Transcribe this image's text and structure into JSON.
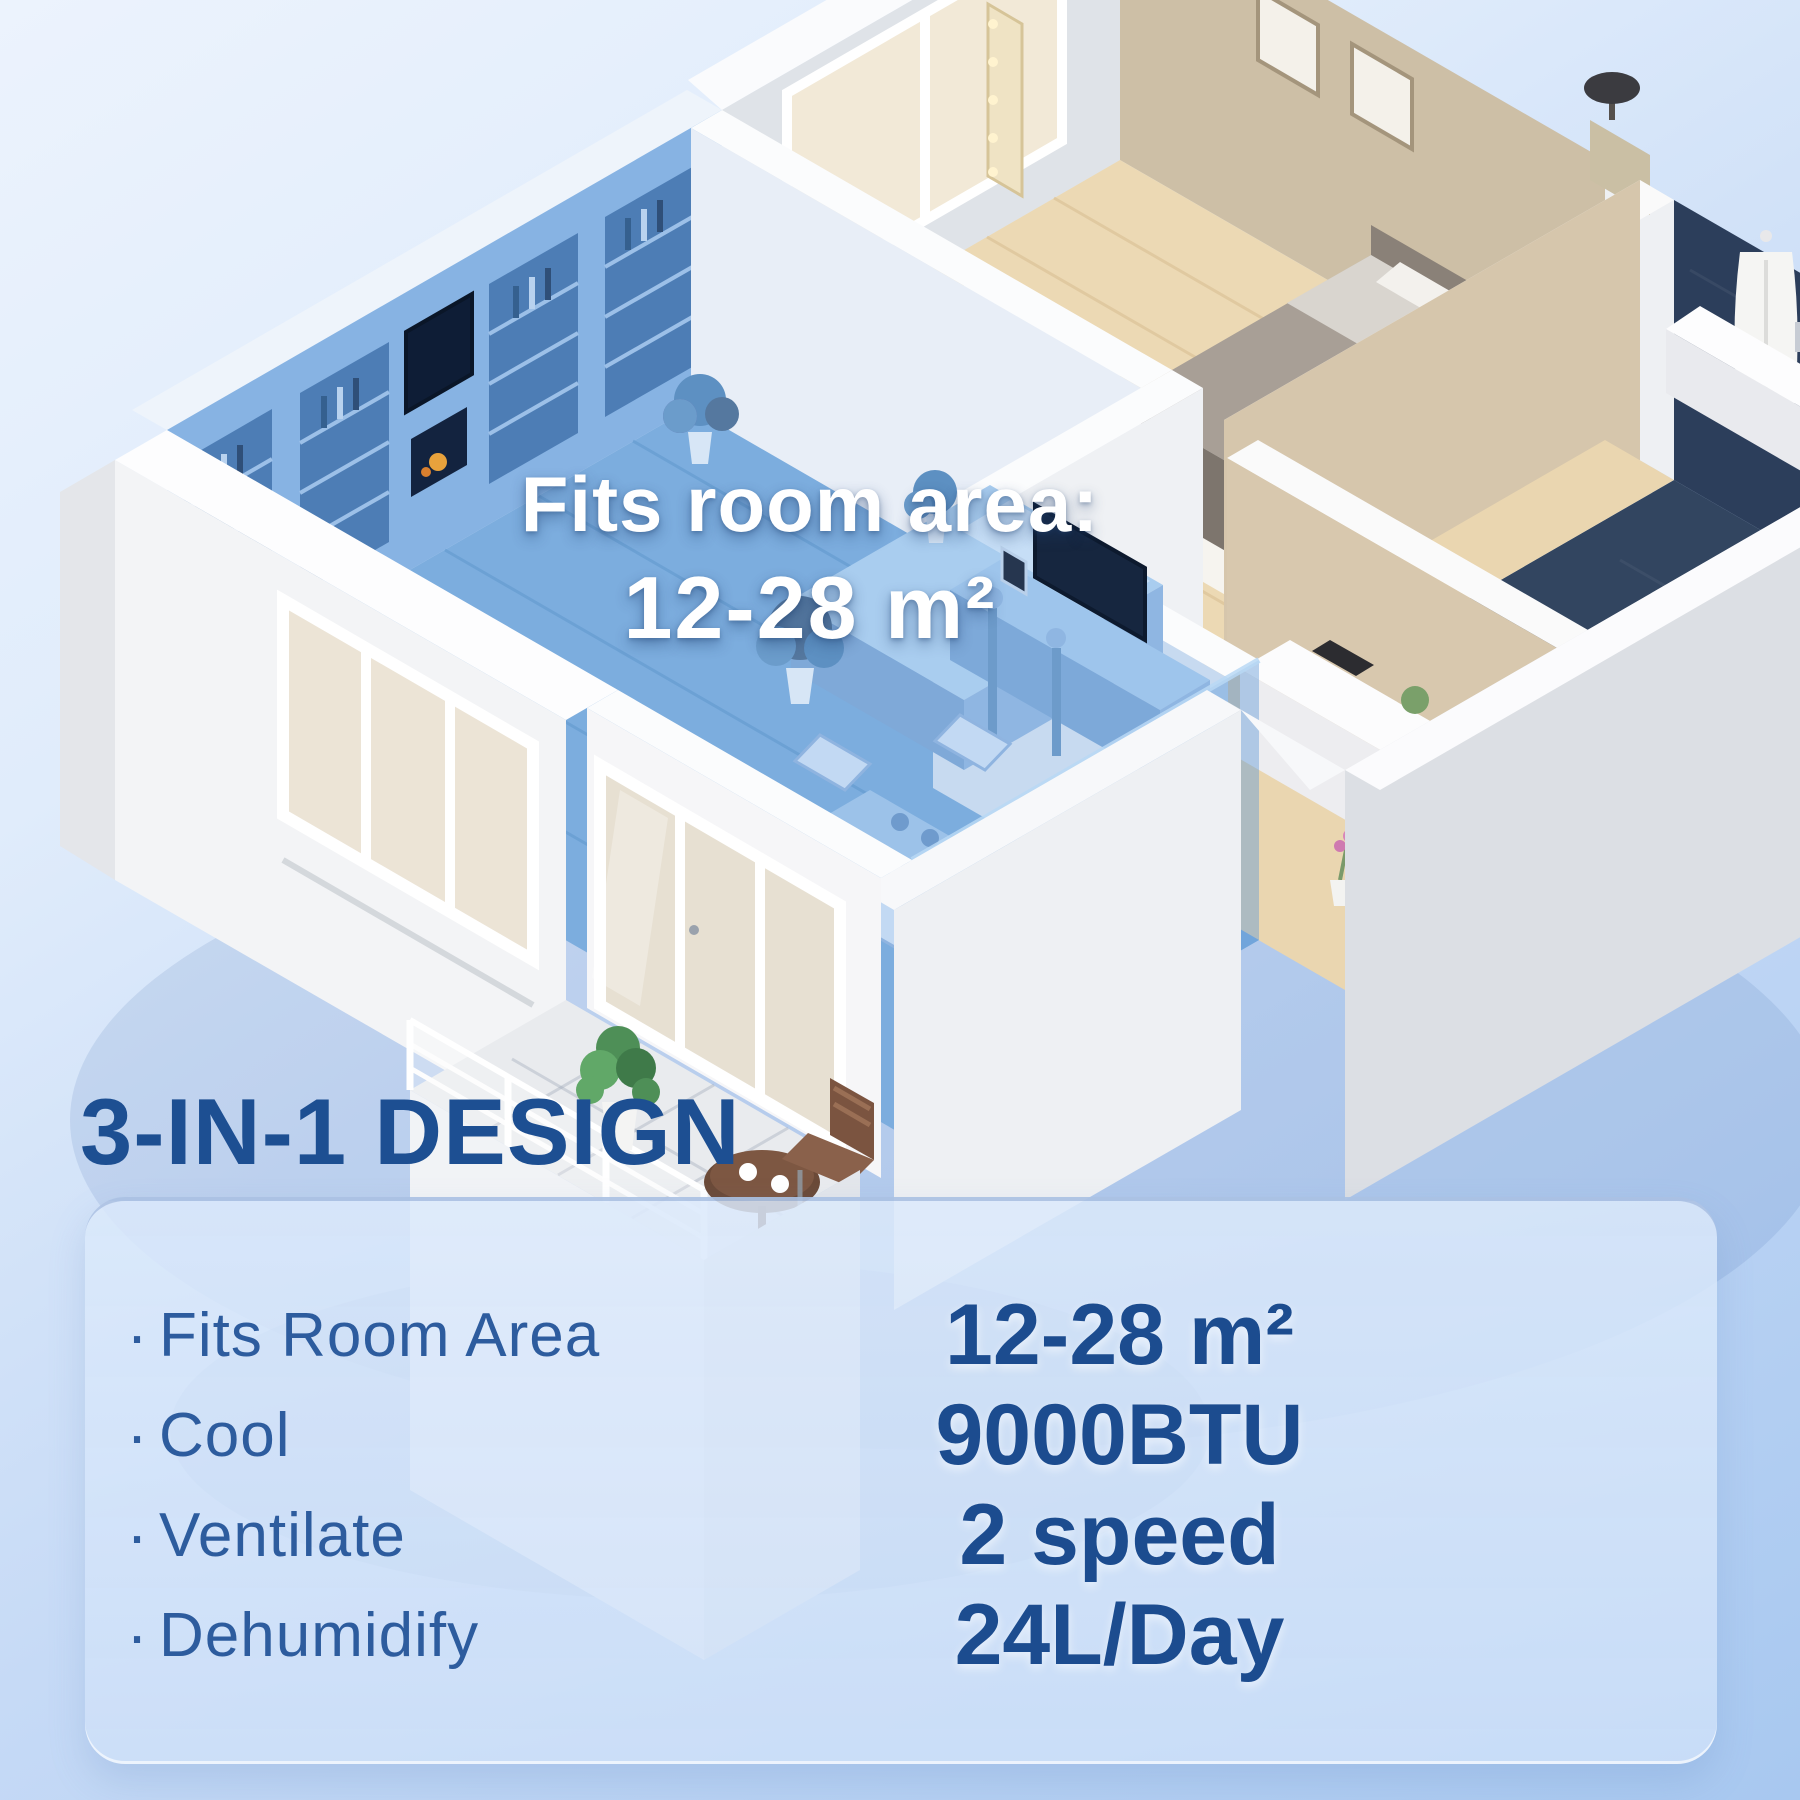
{
  "room_overlay": {
    "title": "Fits room area:",
    "area": "12-28 m²"
  },
  "heading": "3-IN-1 DESIGN",
  "bullet": "·",
  "features": [
    {
      "label": "Fits Room Area",
      "value": "12-28 m²"
    },
    {
      "label": "Cool",
      "value": "9000BTU"
    },
    {
      "label": "Ventilate",
      "value": "2 speed"
    },
    {
      "label": "Dehumidify",
      "value": "24L/Day"
    }
  ],
  "colors": {
    "heading_blue": "#1d4f92",
    "label_blue": "#2d5c9e",
    "value_blue": "#1c4c8f",
    "highlight_blue": "#7cadde",
    "background_top": "#ecf3fd",
    "background_bottom": "#a8c8f0",
    "panel_fill": "rgba(219,233,251,0.85)",
    "overlay_text": "#ffffff"
  }
}
